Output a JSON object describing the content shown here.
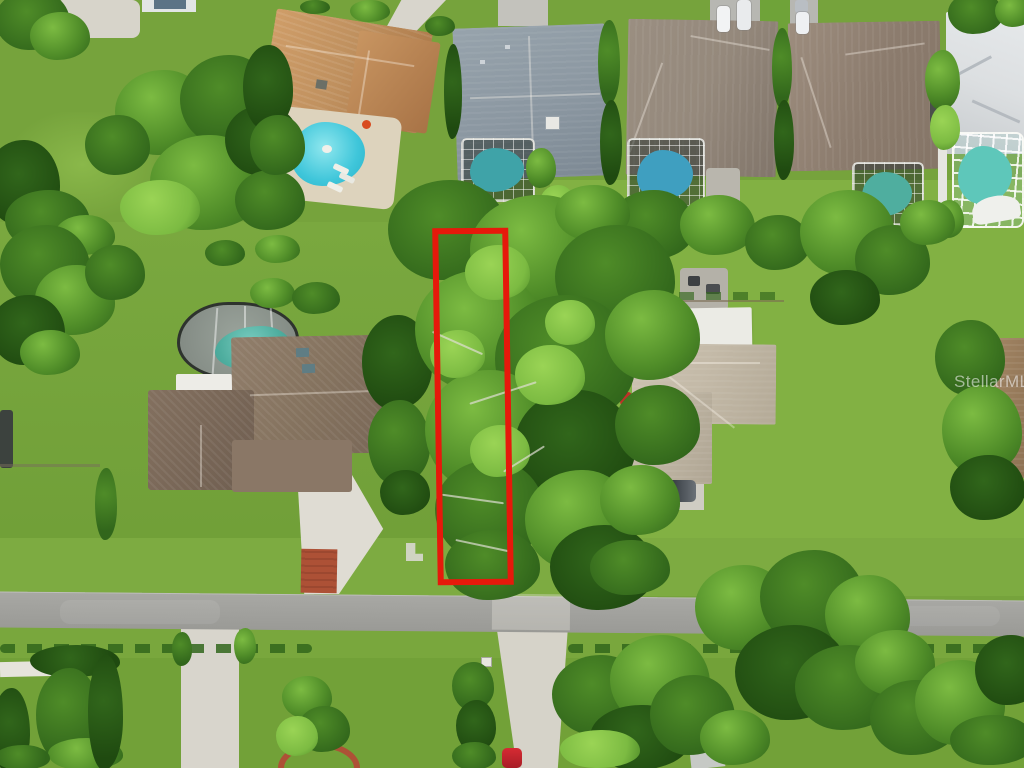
{
  "scene": {
    "type": "aerial-drone-photo",
    "description": "Overhead aerial photo of a suburban Florida neighborhood; a narrow wooded vacant lot between two homes is outlined in red down to the street; houses with screened swimming pools line the top of the frame; a gray residential road runs horizontally near the bottom with driveways, hedges and large tree canopies.",
    "watermark": "StellarMLS",
    "objects": [
      "red-outlined vacant treed lot",
      "residential road",
      "left home with brown roof, screened kidney pool, white driveway with brick apron",
      "right home with greige roof, white garage roof, dark pickup truck, gravel drive",
      "top row of five homes with pools (tan roof, slate roof, two taupe roofs, white roof)",
      "parked white cars at top",
      "red car on lower driveway",
      "hedge rows and large oak canopies"
    ]
  },
  "palette": {
    "grass_base": "#76a33c",
    "grass_light": "#8ab84a",
    "grass_dark": "#6a9a34",
    "tree_bright": "#9ad455",
    "tree_light": "#7cbb42",
    "tree_mid": "#4f8c28",
    "tree_dark": "#31661b",
    "tree_deep": "#1f4a10",
    "road": "#a2a29e",
    "concrete": "#d8d5cc",
    "brick": "#ad5136",
    "boundary_red": "#e6190b",
    "pool_cyan": "#3fc6da",
    "pool_teal": "#4fae9f",
    "roof_tan": "#c0915f",
    "roof_slate": "#8b97a1",
    "roof_brown": "#85735f",
    "roof_taupe": "#95897c",
    "roof_greige": "#c3b9a7",
    "roof_white": "#dcdfe1",
    "enclosure": "rgba(38,50,44,0.52)"
  }
}
